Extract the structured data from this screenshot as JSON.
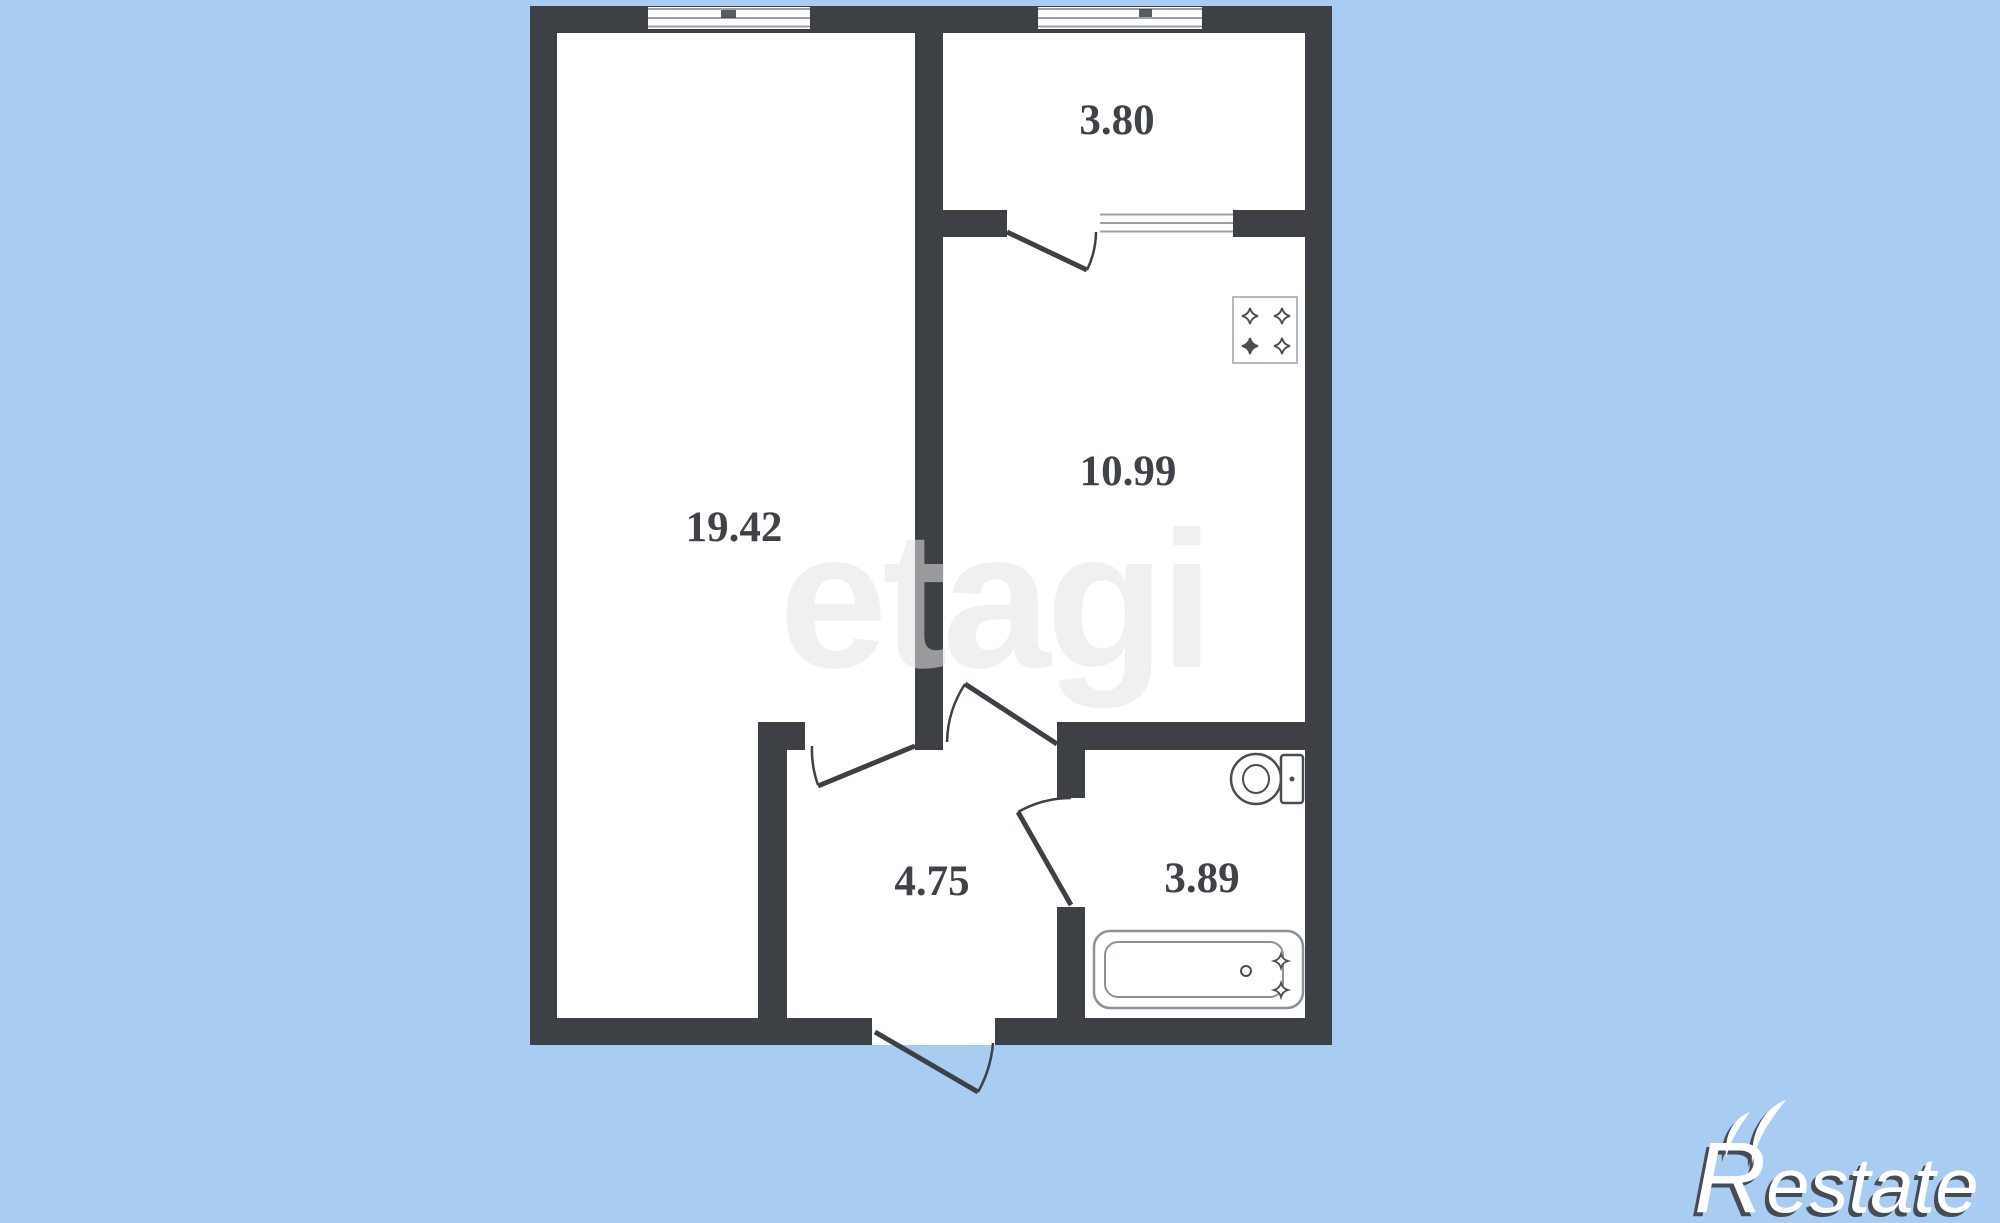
{
  "page": {
    "background_color": "#a9cdf2"
  },
  "watermark": {
    "text": "etagi"
  },
  "logo": {
    "r": "R",
    "rest": "estate",
    "text_color": "#ffffff",
    "shadow_color": "#474b54"
  },
  "plan": {
    "wall_color": "#3d4045",
    "room_fill": "#ffffff",
    "label_color": "#3f4347",
    "rooms": [
      {
        "name": "living-room",
        "area": "19.42"
      },
      {
        "name": "balcony",
        "area": "3.80"
      },
      {
        "name": "kitchen",
        "area": "10.99"
      },
      {
        "name": "hallway",
        "area": "4.75"
      },
      {
        "name": "bathroom",
        "area": "3.89"
      }
    ],
    "fixture_icons": [
      "stove-icon",
      "toilet-icon",
      "bathtub-icon"
    ],
    "feature_icons": [
      "window-icon",
      "door-swing-icon"
    ]
  }
}
